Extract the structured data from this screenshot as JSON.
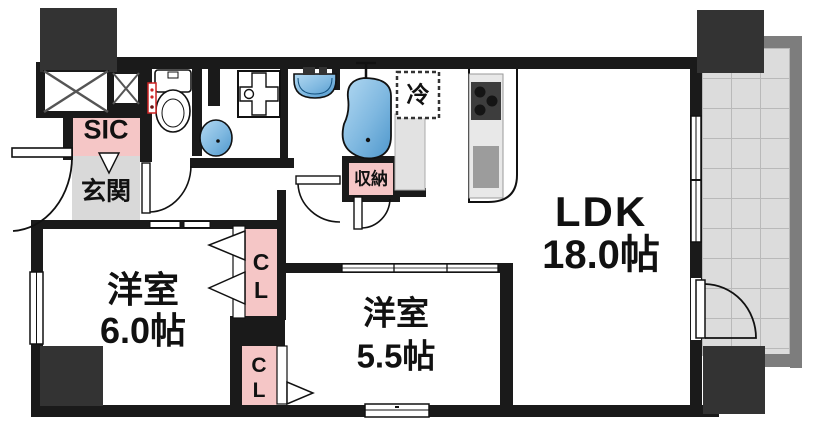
{
  "plan_title": "apartment-floor-plan",
  "rooms": {
    "ldk": {
      "name": "LDK",
      "area": "18.0帖"
    },
    "bedroom1": {
      "name": "洋室",
      "area": "6.0帖"
    },
    "bedroom2": {
      "name": "洋室",
      "area": "5.5帖"
    }
  },
  "labels": {
    "shoe_closet": "SIC",
    "entrance": "玄関",
    "storage": "収納",
    "closet1": "CL",
    "closet2": "CL",
    "fridge_space": "冷"
  },
  "colors": {
    "wall": "#1a1a1a",
    "pillar": "#333333",
    "closet_pink": "#f5c6c6",
    "entrance_gray": "#d9d9d9",
    "balcony_tile": "#dcdcdc",
    "balcony_frame": "#7d7d7d",
    "water_blue_light": "#a9d5ef",
    "water_blue_dark": "#4e97cc",
    "stove_dark": "#3d3d3d",
    "sink_gray": "#9c9c9c"
  }
}
